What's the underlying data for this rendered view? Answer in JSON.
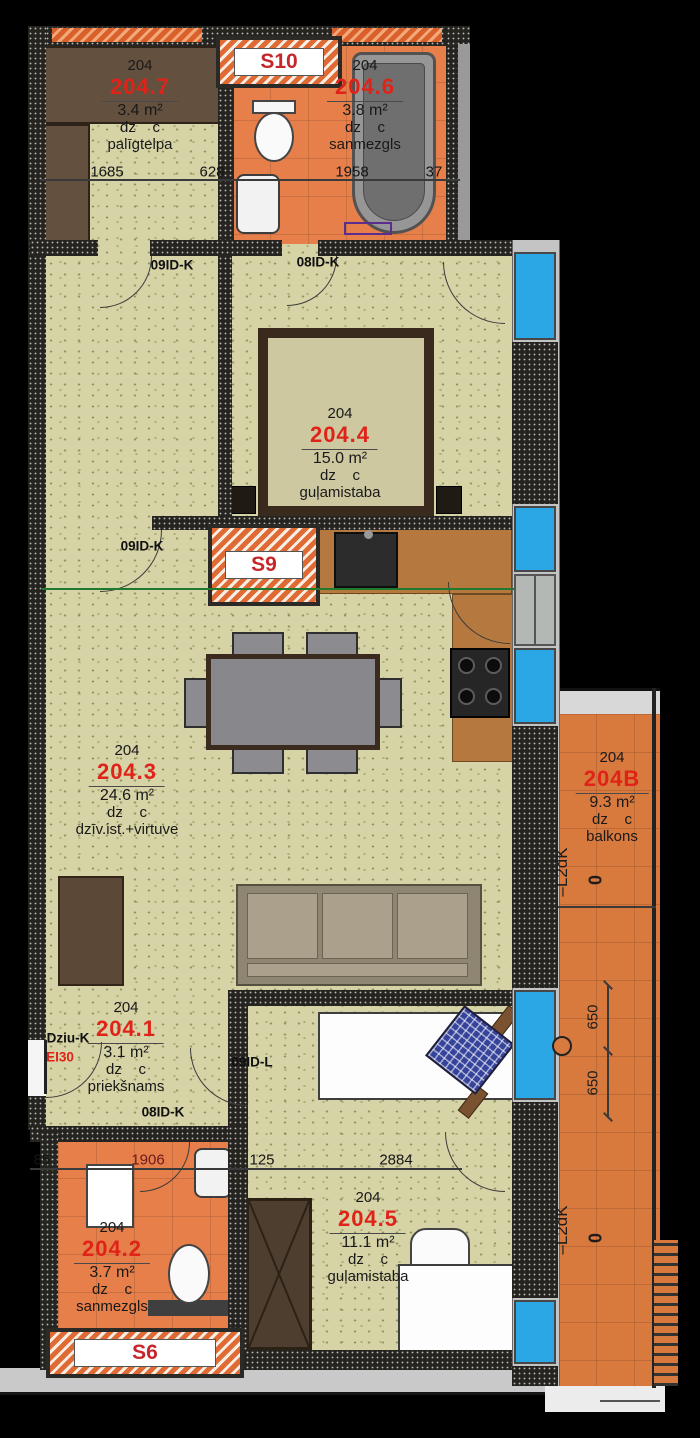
{
  "meta": {
    "drawing": "apartment floor plan",
    "unit_number": "204"
  },
  "shafts": {
    "s10": "S10",
    "s9": "S9",
    "s6": "S6"
  },
  "rooms": {
    "r204_7": {
      "apt": "204",
      "number": "204.7",
      "area": "3.4 m²",
      "use": "dz    c",
      "name": "palīgtelpa"
    },
    "r204_6": {
      "apt": "204",
      "number": "204.6",
      "area": "3.8 m²",
      "use": "dz    c",
      "name": "sanmezgls"
    },
    "r204_4": {
      "apt": "204",
      "number": "204.4",
      "area": "15.0 m²",
      "use": "dz    c",
      "name": "guļamistaba"
    },
    "r204_3": {
      "apt": "204",
      "number": "204.3",
      "area": "24.6 m²",
      "use": "dz    c",
      "name": "dzīv.ist.+virtuve"
    },
    "r204_b": {
      "apt": "204",
      "number": "204B",
      "area": "9.3 m²",
      "use": "dz    c",
      "name": "balkons"
    },
    "r204_1": {
      "apt": "204",
      "number": "204.1",
      "area": "3.1 m²",
      "use": "dz    c",
      "name": "priekšnams"
    },
    "r204_2": {
      "apt": "204",
      "number": "204.2",
      "area": "3.7 m²",
      "use": "dz    c",
      "name": "sanmezgls"
    },
    "r204_5": {
      "apt": "204",
      "number": "204.5",
      "area": "11.1 m²",
      "use": "dz    c",
      "name": "guļamistaba"
    }
  },
  "doors": {
    "top_left": "09ID-K",
    "top_mid": "08ID-K",
    "mid": "09ID-K",
    "hall_right": "09ID-L",
    "hall_bottom": "08ID-K",
    "entry": "Dziu-K",
    "entry_rating": "EI30"
  },
  "dimensions": {
    "top": {
      "d1": "1685",
      "d2": "628",
      "d3": "1958",
      "d4": "37"
    },
    "bottom": {
      "d1": "85",
      "d2": "1906",
      "d3": "125",
      "d4": "2884"
    },
    "balcony": {
      "d1": "650",
      "d2": "650"
    }
  },
  "levels": {
    "upper": {
      "mark": "–L2dK",
      "value": "0"
    },
    "lower": {
      "mark": "–L2dK",
      "value": "0"
    }
  },
  "colors": {
    "accent_red": "#e02318",
    "floor_khaki": "#d6d3a6",
    "floor_orange": "#e67f4a",
    "balcony_orange": "#d8793d",
    "window_blue": "#2aa7e4",
    "wall_dark": "#262420",
    "counter_brown": "#b5793f",
    "furniture_brown": "#5c4837"
  }
}
